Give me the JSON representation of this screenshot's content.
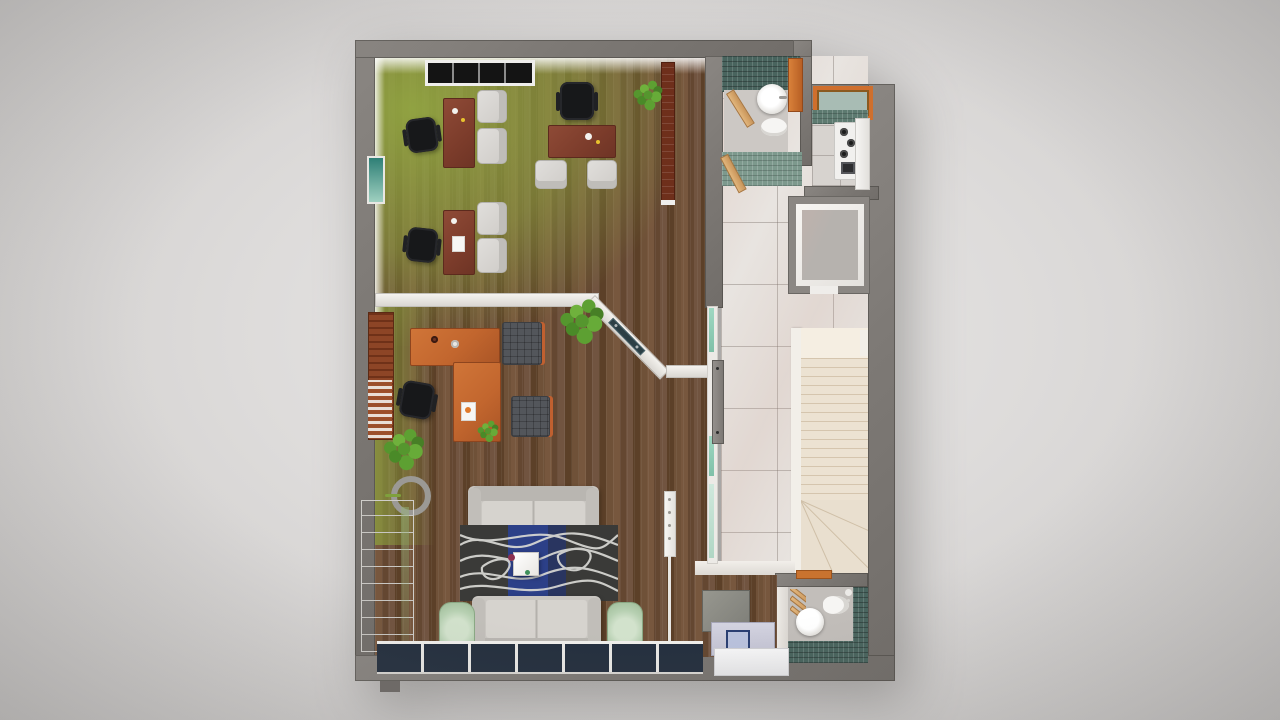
{
  "scene": {
    "title": "3D rendered top-down floor plan of an office apartment",
    "type": "architectural-render",
    "rooms": [
      {
        "name": "open-plan-office",
        "floor": "wood with green tint",
        "contents": [
          "desk-a",
          "desk-b",
          "desk-c",
          "task-chairs",
          "guest-chairs",
          "ceiling-grille-window",
          "tall-brown-cabinet",
          "plant"
        ]
      },
      {
        "name": "reception-lounge",
        "floor": "wood",
        "contents": [
          "l-shaped-orange-desk",
          "task-chair",
          "two-dark-armchairs",
          "glass-partition-with-door",
          "slat-accent-wall",
          "round-mirror",
          "plants",
          "white-cabinet",
          "two-sofas",
          "wave-pattern-rug",
          "coffee-table",
          "two-sage-armchairs",
          "window-wall"
        ]
      },
      {
        "name": "bathroom-top",
        "floor": "gray tile",
        "contents": [
          "round-basin",
          "toilet",
          "teal-mosaic-walls",
          "orange-partition",
          "wood-doors"
        ]
      },
      {
        "name": "kitchen",
        "floor": "marble",
        "contents": [
          "orange-framed-window",
          "teal-backsplash",
          "stove-with-burners",
          "oven",
          "counter"
        ]
      },
      {
        "name": "hallway",
        "floor": "marble tiles",
        "contents": [
          "glass-sliding-door",
          "storage-closet"
        ]
      },
      {
        "name": "staircase",
        "floor": "cream stairs",
        "contents": [
          "straight-flight",
          "winder-turn",
          "white-stringer"
        ]
      },
      {
        "name": "bathroom-bottom",
        "floor": "gray tile",
        "contents": [
          "round-basin",
          "toilet",
          "teal-mosaic-walls",
          "towel-ladder",
          "shower-head",
          "orange-threshold"
        ]
      },
      {
        "name": "under-stair-storage",
        "floor": "wood",
        "contents": [
          "gray-box",
          "lavender-cabinet",
          "white-cabinet"
        ]
      }
    ]
  },
  "palette": {
    "background_center": "#e9e8e7",
    "background_edge": "#c9c7c6",
    "wall_gray": "#7d7975",
    "wood_floor": "#6b4d36",
    "green_floor_tint": "#8da447",
    "marble_floor": "#e8e4e0",
    "stairs_cream": "#ece2d2",
    "teal_tile_dark": "#49645e",
    "teal_tile_light": "#7d998d",
    "accent_orange": "#c66d31",
    "desk_brown": "#82412f",
    "rug_charcoal": "#3a3a38",
    "rug_blue": "#2c4088",
    "sofa_gray": "#c9c6c1",
    "armchair_sage": "#b7d0b2",
    "window_navy": "#25303f",
    "glass_green": "#9fd8c2"
  }
}
